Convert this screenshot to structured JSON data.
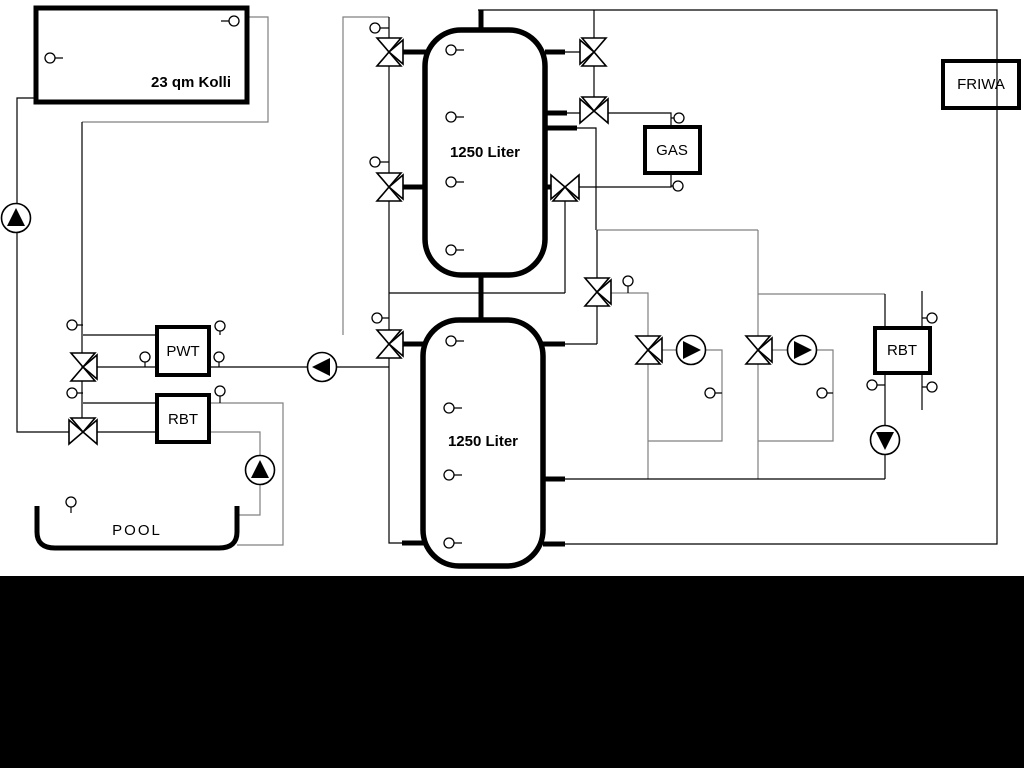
{
  "diagram": {
    "type": "hydraulic-heating-schematic",
    "background_color": "#ffffff",
    "bottom_bar_color": "#000000",
    "colors": {
      "primary_line": "#000000",
      "routing_line": "#808080"
    },
    "labels": {
      "collector": "23 qm Kolli",
      "buffer_tank_top": "1250 Liter",
      "buffer_tank_bottom": "1250 Liter",
      "gas_boiler": "GAS",
      "fresh_water_station": "FRIWA",
      "plate_heat_exchanger": "PWT",
      "heat_exchanger_pool": "RBT",
      "heat_exchanger_right": "RBT",
      "pool": "POOL"
    },
    "components": {
      "pumps": [
        {
          "name": "solar-pump",
          "direction": "up"
        },
        {
          "name": "pwt-circuit-pump",
          "direction": "left"
        },
        {
          "name": "pool-circuit-pump",
          "direction": "up"
        },
        {
          "name": "heating-circuit-1-pump",
          "direction": "right"
        },
        {
          "name": "heating-circuit-2-pump",
          "direction": "right"
        },
        {
          "name": "rbt-circuit-pump",
          "direction": "down"
        }
      ],
      "three_way_valves": 11,
      "temperature_sensors": 28
    }
  }
}
